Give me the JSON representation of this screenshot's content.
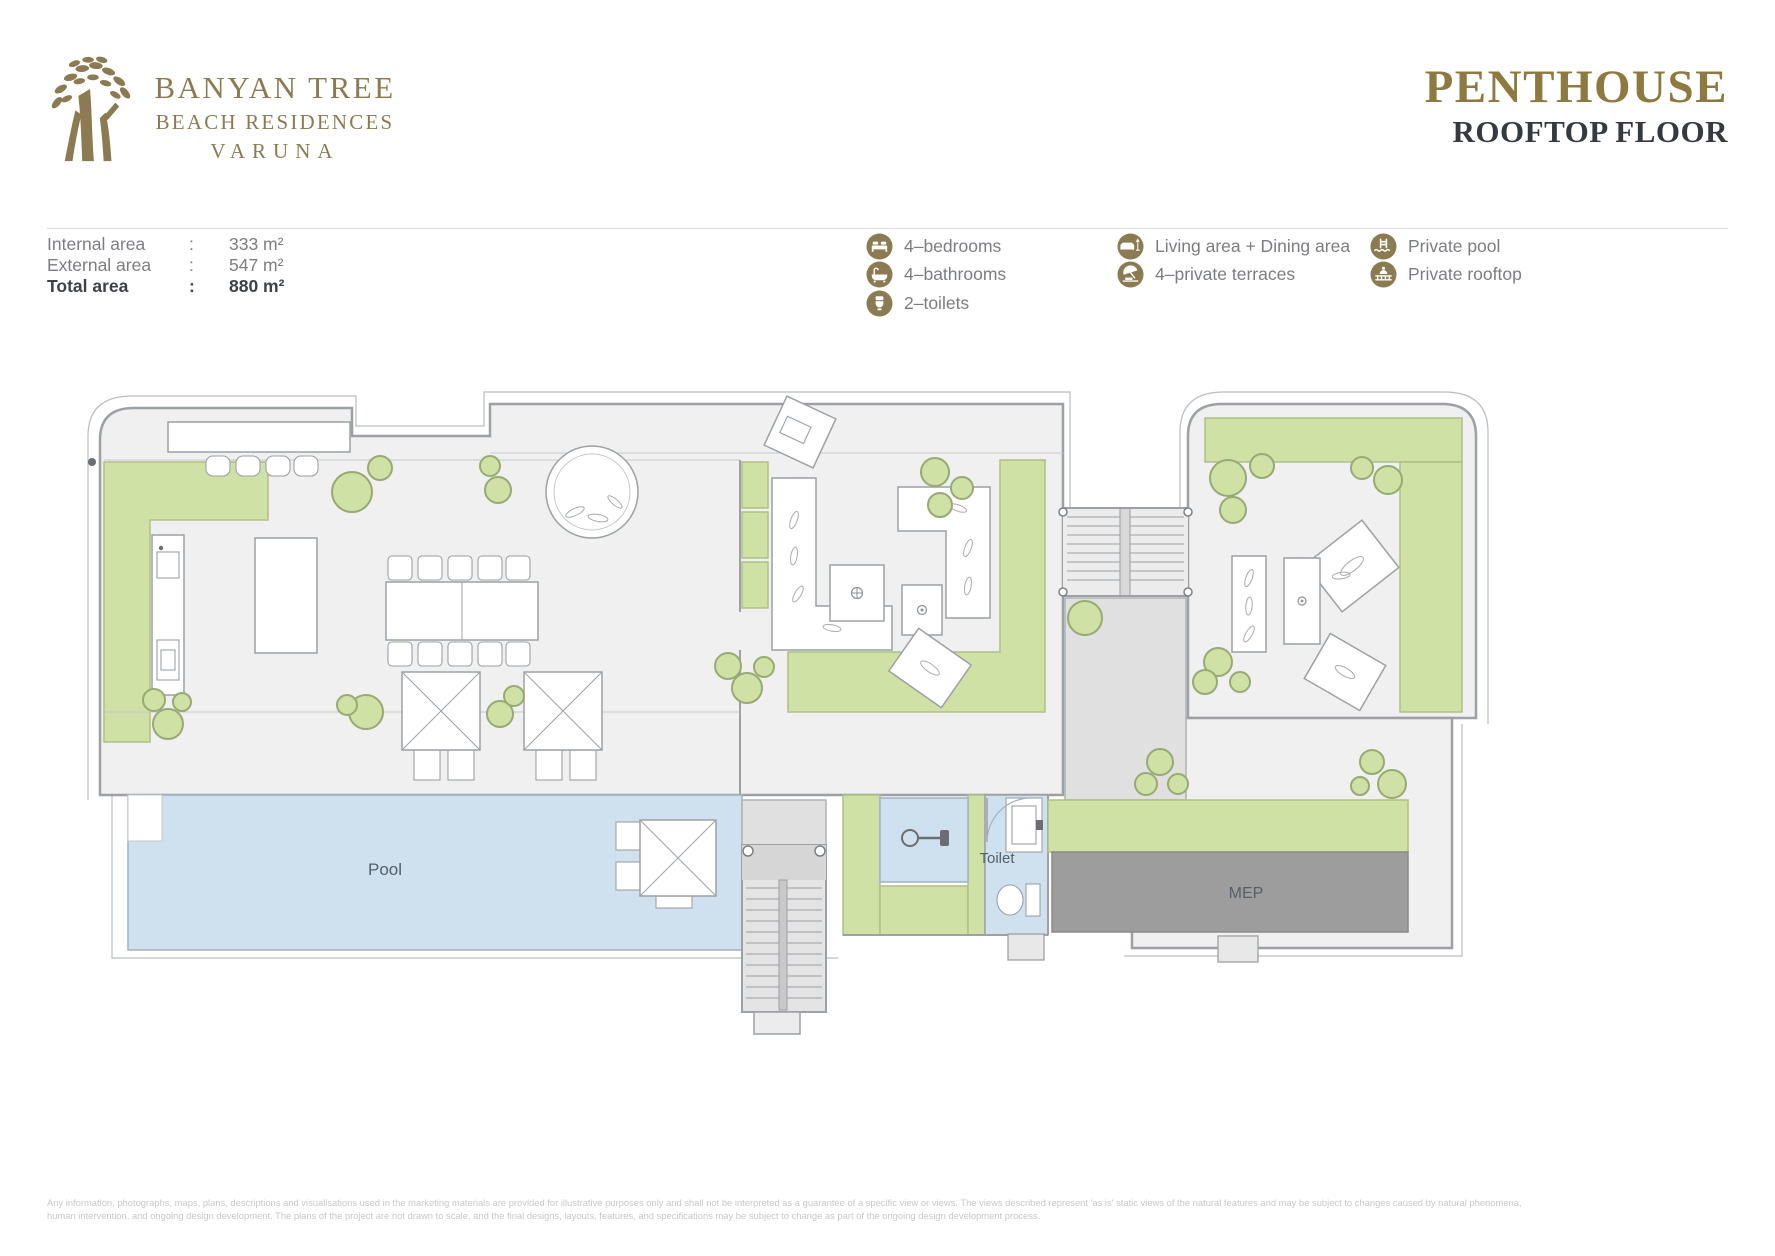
{
  "brand": {
    "line1": "BANYAN TREE",
    "line2": "BEACH RESIDENCES",
    "line3": "VARUNA"
  },
  "title": {
    "main": "PENTHOUSE",
    "sub": "ROOFTOP FLOOR"
  },
  "areas": {
    "rows": [
      {
        "label": "Internal area",
        "sep": ":",
        "value": "333 m²"
      },
      {
        "label": "External area",
        "sep": ":",
        "value": "547 m²"
      },
      {
        "label": "Total area",
        "sep": ":",
        "value": "880 m²"
      }
    ]
  },
  "legend": {
    "col1": [
      {
        "icon": "bed-icon",
        "label": "4–bedrooms"
      },
      {
        "icon": "bathtub-icon",
        "label": "4–bathrooms"
      },
      {
        "icon": "toilet-icon",
        "label": "2–toilets"
      }
    ],
    "col2": [
      {
        "icon": "sofa-lamp-icon",
        "label": "Living area + Dining area"
      },
      {
        "icon": "terrace-umbrella-icon",
        "label": "4–private terraces"
      }
    ],
    "col3": [
      {
        "icon": "pool-ladder-icon",
        "label": "Private pool"
      },
      {
        "icon": "rooftop-icon",
        "label": "Private rooftop"
      }
    ]
  },
  "plan": {
    "labels": {
      "pool": "Pool",
      "toilet": "Toilet",
      "mep": "MEP"
    }
  },
  "disclaimer": {
    "line1": "Any information, photographs, maps, plans, descriptions and visualisations used in the marketing materials are provided for illustrative purposes only and shall not be interpreted as a guarantee of a specific view or views. The views described represent 'as is' static views of the natural features and may be subject to changes caused by natural phenomena,",
    "line2": "human intervention, and ongoing design development. The plans of the project are not drawn to scale, and the final designs, layouts, features, and specifications may be subject to change as part of the ongoing design development process."
  },
  "colors": {
    "gold": "#8c7b52",
    "title_gold": "#8e7940",
    "dark_text": "#343a42",
    "gray_text": "#7b7d80",
    "green": "#cfe1a4",
    "pool_blue": "#cfe0ee",
    "mep_gray": "#9d9d9d",
    "wall_gray": "#9ba1a5"
  }
}
